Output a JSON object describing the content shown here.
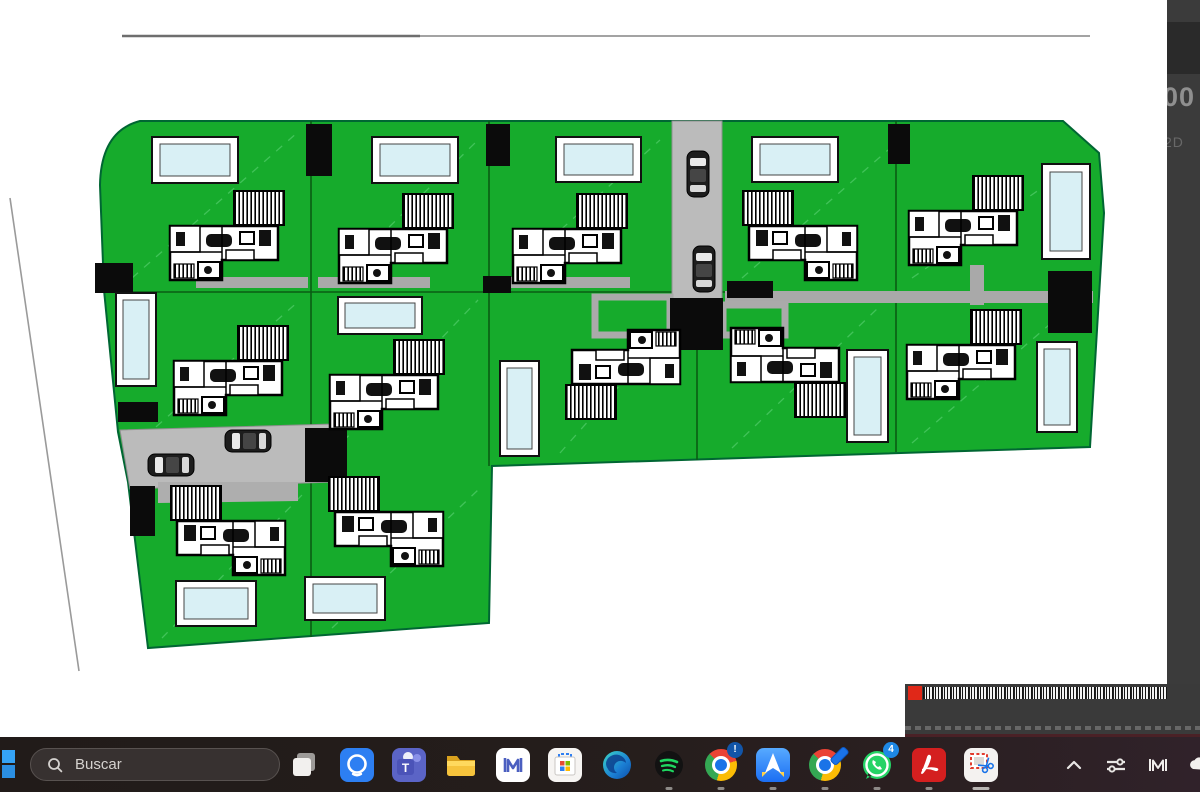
{
  "side_window": {
    "partial_number": "00",
    "partial_label": "2D"
  },
  "plan": {
    "description": "Residential development site plan with twelve villas, pools, roads and parked cars on green plots",
    "villa_count": 12,
    "pool_count": 12,
    "car_count": 4,
    "colors": {
      "grass": "#16AB2C",
      "road": "#BBBBBB",
      "pool_water": "#D9F0F5",
      "pool_frame": "#FFFFFF",
      "outline": "#000000",
      "dashed_boundary": "#46C65E"
    }
  },
  "bottom_window": {
    "legend_swatch_color": "#E02818"
  },
  "taskbar": {
    "search": {
      "placeholder": "Buscar"
    },
    "whatsapp_badge": "4",
    "chrome_badge": "!",
    "icons": [
      {
        "name": "windows-start-icon",
        "running": false
      },
      {
        "name": "task-view-icon",
        "running": false
      },
      {
        "name": "chat-app-icon",
        "running": false
      },
      {
        "name": "teams-icon",
        "running": false
      },
      {
        "name": "file-explorer-icon",
        "running": false
      },
      {
        "name": "m-bars-app-icon",
        "running": false
      },
      {
        "name": "microsoft-store-icon",
        "running": false
      },
      {
        "name": "edge-icon",
        "running": false
      },
      {
        "name": "spotify-icon",
        "running": true
      },
      {
        "name": "chrome-icon",
        "running": true
      },
      {
        "name": "spark-mail-icon",
        "running": true
      },
      {
        "name": "chrome-profile-icon",
        "running": true
      },
      {
        "name": "whatsapp-icon",
        "running": true
      },
      {
        "name": "acrobat-icon",
        "running": true
      },
      {
        "name": "snipping-tool-icon",
        "running": true,
        "active": true
      },
      {
        "name": "tray-expand-icon",
        "running": false
      },
      {
        "name": "tray-tune-icon",
        "running": false
      },
      {
        "name": "tray-m-icon",
        "running": false
      },
      {
        "name": "onedrive-cloud-icon",
        "running": false
      }
    ]
  }
}
